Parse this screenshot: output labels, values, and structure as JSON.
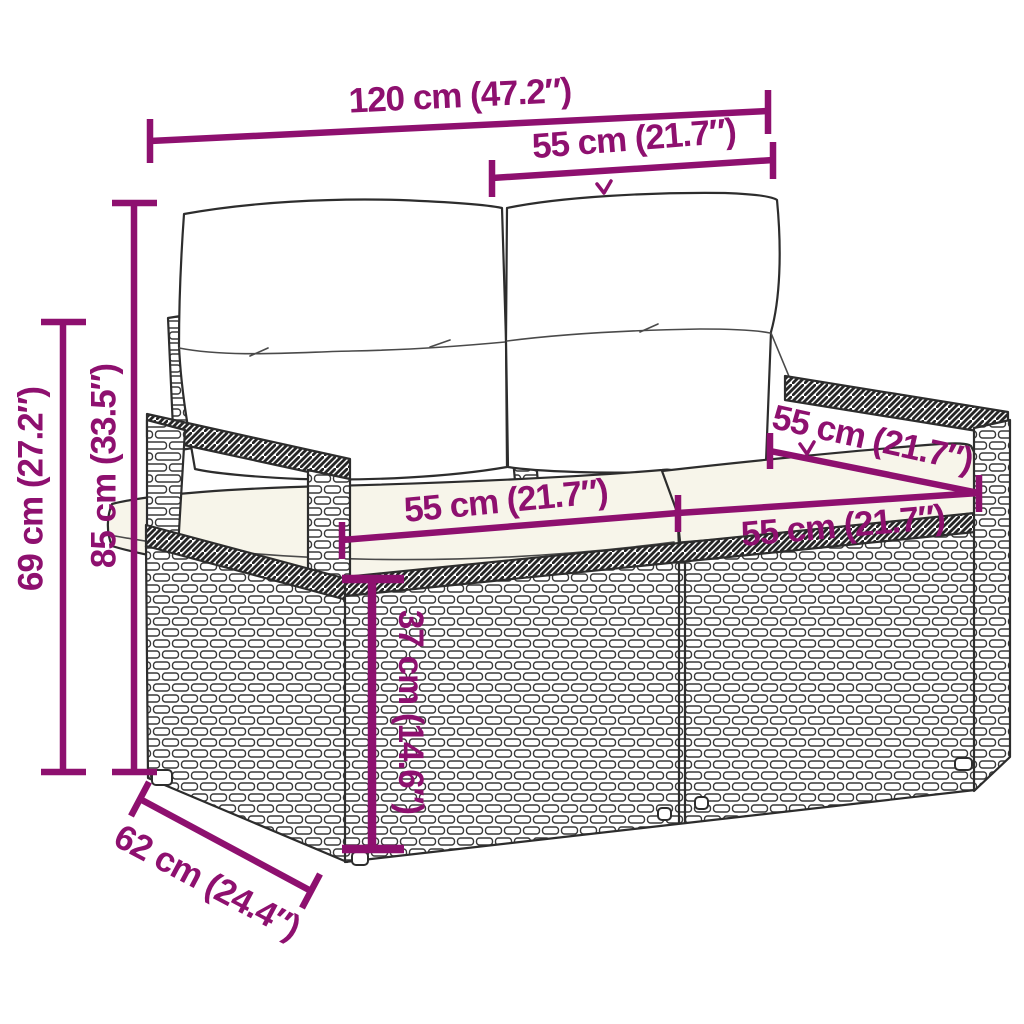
{
  "diagram": {
    "type": "furniture-dimension-diagram",
    "subject": "rattan-2-seater-garden-sofa-with-cushions",
    "colors": {
      "accent": "#8E106F",
      "ink": "#2D2D2D",
      "cushion": "#F7F5EA"
    },
    "dims": {
      "total_width": "120 cm (47.2″)",
      "backrest_width": "55 cm (21.7″)",
      "total_height": "85 cm (33.5″)",
      "armrest_height": "69 cm (27.2″)",
      "left_seat_width": "55 cm (21.7″)",
      "right_seat_width": "55 cm (21.7″)",
      "armrest_depth": "55 cm (21.7″)",
      "seat_height": "37 cm (14.6″)",
      "base_depth": "62 cm (24.4″)"
    }
  }
}
